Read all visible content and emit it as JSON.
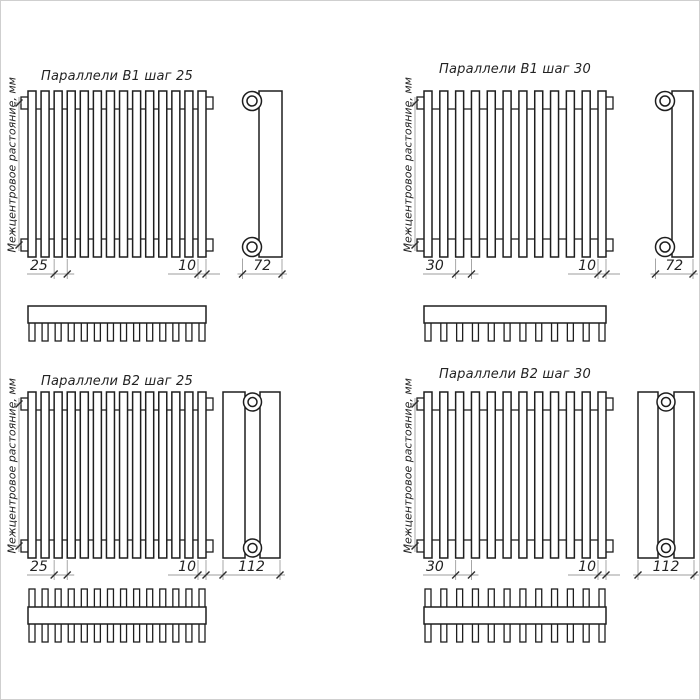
{
  "canvas": {
    "width": 700,
    "height": 700,
    "background": "#ffffff",
    "frame_color": "#cfcfcf"
  },
  "colors": {
    "object_line": "#1e1e1e",
    "dimension_line": "#9d9d9d",
    "text": "#232323"
  },
  "vertical_dim_label": "Межцентровое растояние, мм",
  "diagrams": [
    {
      "title": "Параллели В1 шаг 25",
      "pitch_label": "25",
      "tube_width_label": "10",
      "depth_label": "72",
      "tube_count": 14,
      "rows": 1
    },
    {
      "title": "Параллели В1 шаг 30",
      "pitch_label": "30",
      "tube_width_label": "10",
      "depth_label": "72",
      "tube_count": 12,
      "rows": 1
    },
    {
      "title": "Параллели В2 шаг 25",
      "pitch_label": "25",
      "tube_width_label": "10",
      "depth_label": "112",
      "tube_count": 14,
      "rows": 2
    },
    {
      "title": "Параллели В2 шаг 30",
      "pitch_label": "30",
      "tube_width_label": "10",
      "depth_label": "112",
      "tube_count": 12,
      "rows": 2
    }
  ]
}
